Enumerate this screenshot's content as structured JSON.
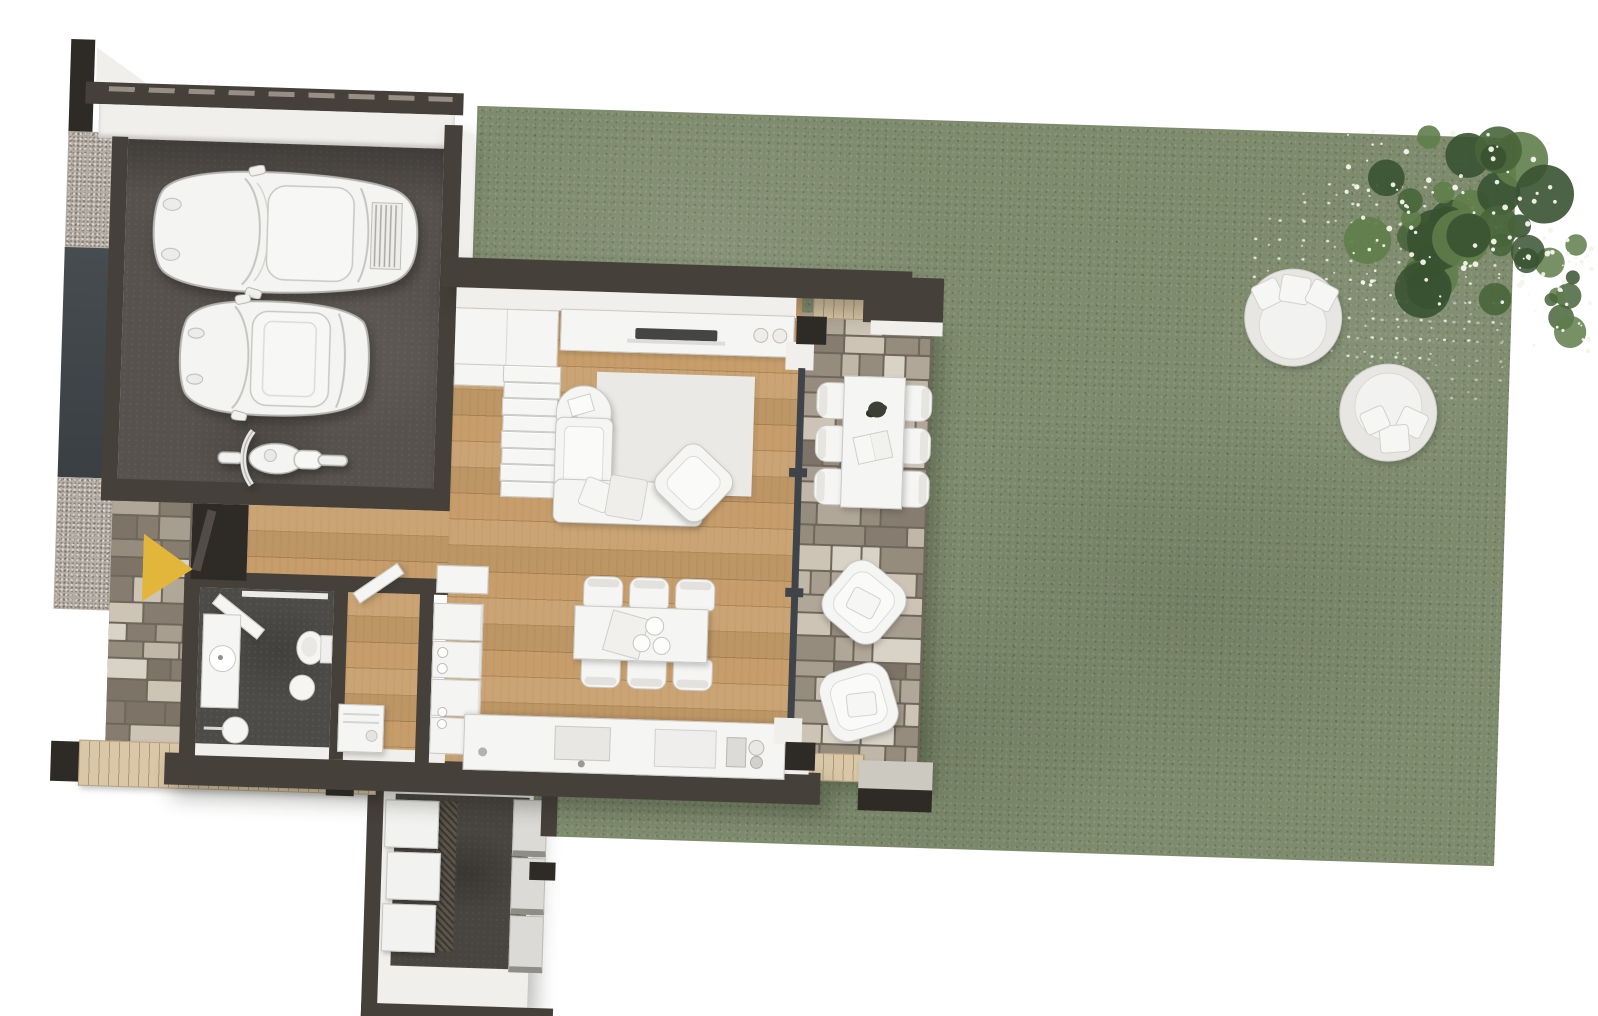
{
  "scene": {
    "type": "3d-floor-plan-top-view",
    "rooms": [
      "garage",
      "entry",
      "hallway",
      "bathroom",
      "utility-room",
      "living-room",
      "dining-area",
      "kitchen",
      "cellar"
    ],
    "outdoor": [
      "lawn",
      "stone-patio",
      "wood-deck",
      "gravel-path",
      "driveway",
      "flowering-tree",
      "round-daybeds",
      "concrete-step"
    ],
    "vehicles": [
      "sports-car",
      "compact-car",
      "motorcycle"
    ],
    "furniture": {
      "living": [
        "wall-cabinets",
        "staircase",
        "tv-console",
        "tv",
        "area-rug",
        "sofa",
        "armchair",
        "side-table"
      ],
      "dining": [
        "dining-table",
        "dining-chairs",
        "serving-tray",
        "plates"
      ],
      "kitchen": [
        "counter",
        "sink",
        "faucet",
        "cooktop",
        "coffee-machine",
        "oven-column"
      ],
      "bathroom": [
        "vanity-sink",
        "toilet",
        "bidet",
        "stool",
        "interior-door"
      ],
      "utility": [
        "washing-machine",
        "interior-door",
        "wall-shelves"
      ],
      "patio": [
        "outdoor-dining-table",
        "outdoor-chairs",
        "plant-centerpiece",
        "open-book",
        "lounge-chairs"
      ]
    },
    "markers": [
      "entrance-arrow"
    ]
  },
  "palette": {
    "wall": "#46403a",
    "wall_dark": "#2e2b26",
    "wall_face": "#f1efec",
    "garage_floor": "#57524e",
    "driveway": "#42474b",
    "gravel": "#b6ada5",
    "wood": "#c79e6b",
    "deck": "#d9c7a7",
    "stone_gap": "#6f675c",
    "grass": "#7e8b6d",
    "furn": "#f5f5f3",
    "furn_edge": "#c9c8c4",
    "rug": "#ebe9e5",
    "bath_floor": "#4c4b48",
    "cellar_floor": "#48443f",
    "concrete": "#ccc9c1",
    "glass": "#3f444a",
    "arrow": "#e2b53b",
    "tv": "#454545",
    "tree1": "#48653a",
    "tree2": "#385231",
    "tree3": "#5f7d4a",
    "blossom": "#f4f5ea"
  },
  "generators": {
    "stairs": {
      "steps": 8
    },
    "dining_chairs": {
      "per_side": 3
    },
    "patio_chairs": {
      "per_side": 3
    },
    "appliance_column": {
      "units": 4
    },
    "cellar": {
      "boxes": 3,
      "steps": 3
    },
    "deck": {
      "posts": 2
    },
    "daybeds": {
      "count": 2,
      "pillows": 3
    },
    "tree": {
      "blobs": 30,
      "sub_blobs": 10,
      "blossoms": 110
    },
    "stone_palette": [
      "#cdc4b6",
      "#b1a798",
      "#968c7e",
      "#d9d3c7",
      "#a89e90",
      "#867c6f",
      "#c1b7a9",
      "#7d7467"
    ]
  }
}
